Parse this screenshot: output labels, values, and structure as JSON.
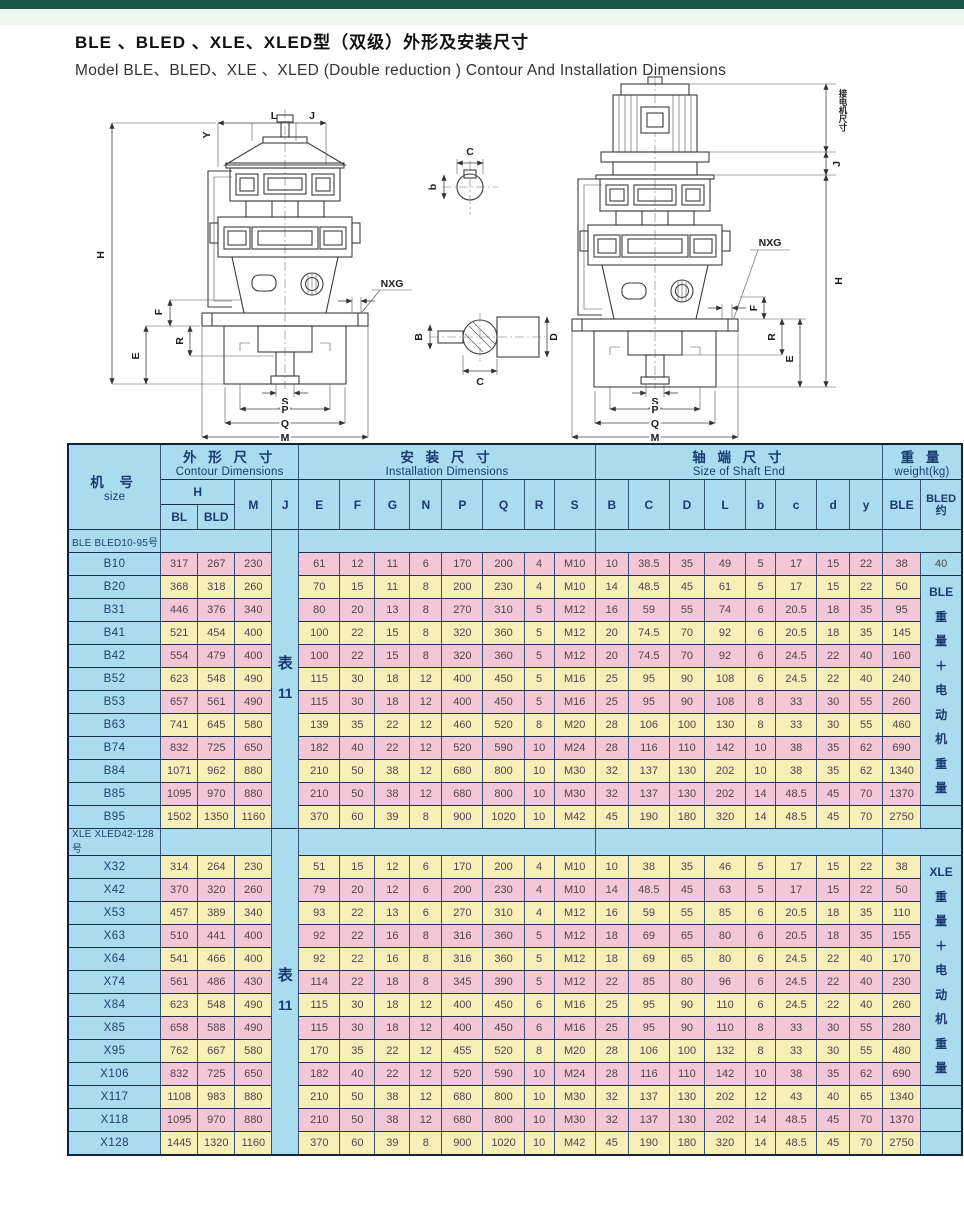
{
  "page": {
    "title_zh": "BLE 、BLED 、XLE、XLED型（双级）外形及安装尺寸",
    "title_en": "Model BLE、BLED、XLE 、XLED (Double reduction ) Contour And Installation Dimensions",
    "colors": {
      "top_bar": "#1b5747",
      "table_blue": "#a9dcef",
      "row_pink": "#f3c7d5",
      "row_yellow": "#f6efb7",
      "border_navy": "#1f2f50",
      "header_text": "#1c3a70"
    }
  },
  "drawings": {
    "labels": {
      "H": "H",
      "Y": "Y",
      "L": "L",
      "J": "J",
      "F": "F",
      "E": "E",
      "R": "R",
      "NXG": "NXG",
      "S": "S",
      "P": "P",
      "Q": "Q",
      "M": "M",
      "B": "B",
      "C": "C",
      "D": "D",
      "b": "b",
      "motor_connect": "接电机尺寸"
    }
  },
  "table": {
    "header": {
      "size_zh": "机 号",
      "size_en": "size",
      "groups": [
        {
          "zh": "外 形 尺 寸",
          "en": "Contour Dimensions",
          "span": 4
        },
        {
          "zh": "安 装 尺 寸",
          "en": "Installation  Dimensions",
          "span": 8
        },
        {
          "zh": "轴 端 尺 寸",
          "en": "Size of Shaft  End",
          "span": 8
        },
        {
          "zh": "重 量",
          "en": "weight(kg)",
          "span": 2
        }
      ],
      "h_label": "H",
      "h_sub": [
        "BL",
        "BLD"
      ],
      "letters": [
        "M",
        "J",
        "E",
        "F",
        "G",
        "N",
        "P",
        "Q",
        "R",
        "S",
        "B",
        "C",
        "D",
        "L",
        "b",
        "c",
        "d",
        "y",
        "BLE"
      ],
      "bled_lines": [
        "BLED",
        "约"
      ]
    },
    "sections": [
      {
        "label": "BLE BLED10-95号",
        "first_stripe": "pink",
        "j_note": [
          "表",
          "11"
        ],
        "weight_note": {
          "start": 1,
          "span": 10,
          "lines": [
            "BLE",
            "重",
            "量",
            "＋",
            "电",
            "动",
            "机",
            "重",
            "量"
          ]
        },
        "rows": [
          {
            "size": "B10",
            "bled": "40",
            "cells": [
              317,
              267,
              230,
              61,
              12,
              11,
              6,
              170,
              200,
              4,
              "M10",
              10,
              38.5,
              35,
              49,
              5,
              17,
              15,
              22,
              38
            ]
          },
          {
            "size": "B20",
            "cells": [
              368,
              318,
              260,
              70,
              15,
              11,
              8,
              200,
              230,
              4,
              "M10",
              14,
              48.5,
              45,
              61,
              5,
              17,
              15,
              22,
              50
            ]
          },
          {
            "size": "B31",
            "cells": [
              446,
              376,
              340,
              80,
              20,
              13,
              8,
              270,
              310,
              5,
              "M12",
              16,
              59,
              55,
              74,
              6,
              20.5,
              18,
              35,
              95
            ]
          },
          {
            "size": "B41",
            "cells": [
              521,
              454,
              400,
              100,
              22,
              15,
              8,
              320,
              360,
              5,
              "M12",
              20,
              74.5,
              70,
              92,
              6,
              20.5,
              18,
              35,
              145
            ]
          },
          {
            "size": "B42",
            "cells": [
              554,
              479,
              400,
              100,
              22,
              15,
              8,
              320,
              360,
              5,
              "M12",
              20,
              74.5,
              70,
              92,
              6,
              24.5,
              22,
              40,
              160
            ]
          },
          {
            "size": "B52",
            "cells": [
              623,
              548,
              490,
              115,
              30,
              18,
              12,
              400,
              450,
              5,
              "M16",
              25,
              95,
              90,
              108,
              6,
              24.5,
              22,
              40,
              240
            ]
          },
          {
            "size": "B53",
            "cells": [
              657,
              561,
              490,
              115,
              30,
              18,
              12,
              400,
              450,
              5,
              "M16",
              25,
              95,
              90,
              108,
              8,
              33,
              30,
              55,
              260
            ]
          },
          {
            "size": "B63",
            "cells": [
              741,
              645,
              580,
              139,
              35,
              22,
              12,
              460,
              520,
              8,
              "M20",
              28,
              106,
              100,
              130,
              8,
              33,
              30,
              55,
              460
            ]
          },
          {
            "size": "B74",
            "cells": [
              832,
              725,
              650,
              182,
              40,
              22,
              12,
              520,
              590,
              10,
              "M24",
              28,
              116,
              110,
              142,
              10,
              38,
              35,
              62,
              690
            ]
          },
          {
            "size": "B84",
            "cells": [
              1071,
              962,
              880,
              210,
              50,
              38,
              12,
              680,
              800,
              10,
              "M30",
              32,
              137,
              130,
              202,
              10,
              38,
              35,
              62,
              1340
            ]
          },
          {
            "size": "B85",
            "cells": [
              1095,
              970,
              880,
              210,
              50,
              38,
              12,
              680,
              800,
              10,
              "M30",
              32,
              137,
              130,
              202,
              14,
              48.5,
              45,
              70,
              1370
            ]
          },
          {
            "size": "B95",
            "cells": [
              1502,
              1350,
              1160,
              370,
              60,
              39,
              8,
              900,
              1020,
              10,
              "M42",
              45,
              190,
              180,
              320,
              14,
              48.5,
              45,
              70,
              2750
            ]
          }
        ]
      },
      {
        "label": "XLE XLED42-128号",
        "first_stripe": "yellow",
        "j_note": [
          "表",
          "11"
        ],
        "weight_note": {
          "start": 0,
          "span": 10,
          "lines": [
            "XLE",
            "重",
            "量",
            "＋",
            "电",
            "动",
            "机",
            "重",
            "量"
          ]
        },
        "rows": [
          {
            "size": "X32",
            "cells": [
              314,
              264,
              230,
              51,
              15,
              12,
              6,
              170,
              200,
              4,
              "M10",
              10,
              38,
              35,
              46,
              5,
              17,
              15,
              22,
              38
            ]
          },
          {
            "size": "X42",
            "cells": [
              370,
              320,
              260,
              79,
              20,
              12,
              6,
              200,
              230,
              4,
              "M10",
              14,
              48.5,
              45,
              63,
              5,
              17,
              15,
              22,
              50
            ]
          },
          {
            "size": "X53",
            "cells": [
              457,
              389,
              340,
              93,
              22,
              13,
              6,
              270,
              310,
              4,
              "M12",
              16,
              59,
              55,
              85,
              6,
              20.5,
              18,
              35,
              110
            ]
          },
          {
            "size": "X63",
            "cells": [
              510,
              441,
              400,
              92,
              22,
              16,
              8,
              316,
              360,
              5,
              "M12",
              18,
              69,
              65,
              80,
              6,
              20.5,
              18,
              35,
              155
            ]
          },
          {
            "size": "X64",
            "cells": [
              541,
              466,
              400,
              92,
              22,
              16,
              8,
              316,
              360,
              5,
              "M12",
              18,
              69,
              65,
              80,
              6,
              24.5,
              22,
              40,
              170
            ]
          },
          {
            "size": "X74",
            "cells": [
              561,
              486,
              430,
              114,
              22,
              18,
              8,
              345,
              390,
              5,
              "M12",
              22,
              85,
              80,
              96,
              6,
              24.5,
              22,
              40,
              230
            ]
          },
          {
            "size": "X84",
            "cells": [
              623,
              548,
              490,
              115,
              30,
              18,
              12,
              400,
              450,
              6,
              "M16",
              25,
              95,
              90,
              110,
              6,
              24.5,
              22,
              40,
              260
            ]
          },
          {
            "size": "X85",
            "cells": [
              658,
              588,
              490,
              115,
              30,
              18,
              12,
              400,
              450,
              6,
              "M16",
              25,
              95,
              90,
              110,
              8,
              33,
              30,
              55,
              280
            ]
          },
          {
            "size": "X95",
            "cells": [
              762,
              667,
              580,
              170,
              35,
              22,
              12,
              455,
              520,
              8,
              "M20",
              28,
              106,
              100,
              132,
              8,
              33,
              30,
              55,
              480
            ]
          },
          {
            "size": "X106",
            "cells": [
              832,
              725,
              650,
              182,
              40,
              22,
              12,
              520,
              590,
              10,
              "M24",
              28,
              116,
              110,
              142,
              10,
              38,
              35,
              62,
              690
            ]
          },
          {
            "size": "X117",
            "cells": [
              1108,
              983,
              880,
              210,
              50,
              38,
              12,
              680,
              800,
              10,
              "M30",
              32,
              137,
              130,
              202,
              12,
              43,
              40,
              65,
              1340
            ]
          },
          {
            "size": "X118",
            "cells": [
              1095,
              970,
              880,
              210,
              50,
              38,
              12,
              680,
              800,
              10,
              "M30",
              32,
              137,
              130,
              202,
              14,
              48.5,
              45,
              70,
              1370
            ]
          },
          {
            "size": "X128",
            "cells": [
              1445,
              1320,
              1160,
              370,
              60,
              39,
              8,
              900,
              1020,
              10,
              "M42",
              45,
              190,
              180,
              320,
              14,
              48.5,
              45,
              70,
              2750
            ]
          }
        ]
      }
    ]
  }
}
